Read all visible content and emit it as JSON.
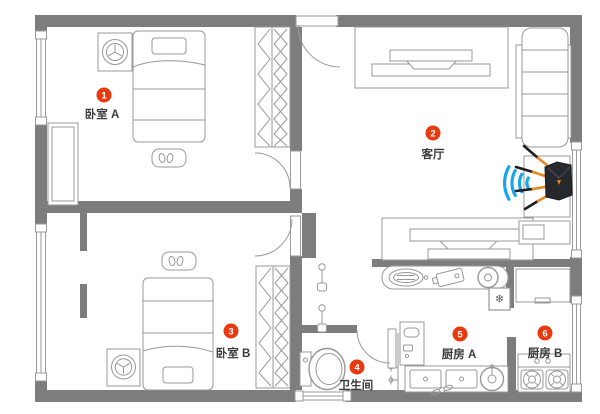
{
  "app": {
    "type": "apartment-floor-plan"
  },
  "palette": {
    "wall": "#7d7d7d",
    "furniture_line": "#989898",
    "badge_red": "#e8390f",
    "label_text": "#3b3b3b",
    "wifi_blue": "#17a7e8",
    "router_body": "#27272e",
    "antenna_orange": "#e8871e"
  },
  "rooms": [
    {
      "badge": "1",
      "label": "卧室 A"
    },
    {
      "badge": "2",
      "label": "客厅"
    },
    {
      "badge": "3",
      "label": "卧室 B"
    },
    {
      "badge": "4",
      "label": "卫生间"
    },
    {
      "badge": "5",
      "label": "厨房 A"
    },
    {
      "badge": "6",
      "label": "厨房 B"
    }
  ],
  "icons": {
    "freezer_snowflake": "❄"
  },
  "device": {
    "name": "wifi-router",
    "signal": "wifi-signal-waves"
  }
}
